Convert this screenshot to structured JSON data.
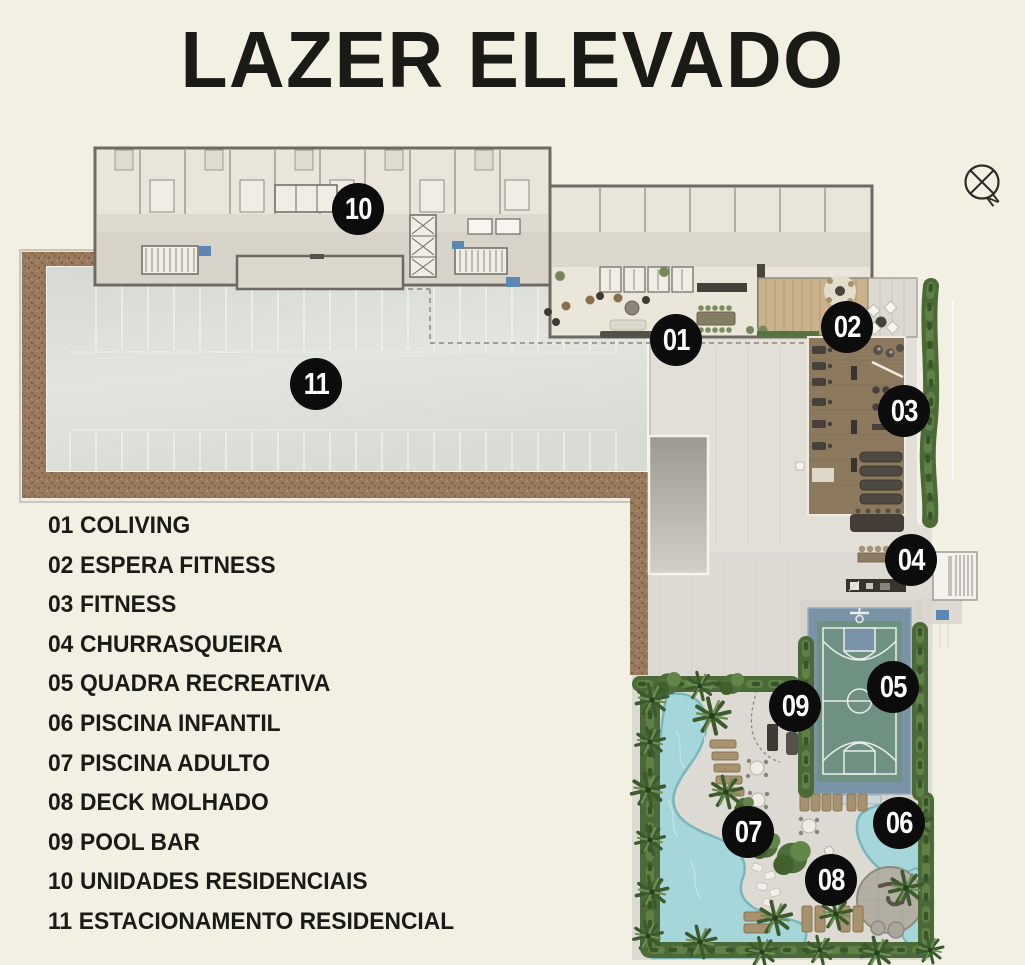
{
  "header": {
    "title": "LAZER ELEVADO"
  },
  "compass": {
    "north_label": "N"
  },
  "legend": {
    "items": [
      {
        "num": "01",
        "label": "COLIVING"
      },
      {
        "num": "02",
        "label": "ESPERA FITNESS"
      },
      {
        "num": "03",
        "label": "FITNESS"
      },
      {
        "num": "04",
        "label": "CHURRASQUEIRA"
      },
      {
        "num": "05",
        "label": "QUADRA RECREATIVA"
      },
      {
        "num": "06",
        "label": "PISCINA INFANTIL"
      },
      {
        "num": "07",
        "label": "PISCINA ADULTO"
      },
      {
        "num": "08",
        "label": "DECK MOLHADO"
      },
      {
        "num": "09",
        "label": "POOL BAR"
      },
      {
        "num": "10",
        "label": "UNIDADES RESIDENCIAIS"
      },
      {
        "num": "11",
        "label": "ESTACIONAMENTO RESIDENCIAL"
      }
    ]
  },
  "markers": [
    {
      "number": "01",
      "area": "COLIVING"
    },
    {
      "number": "02",
      "area": "ESPERA FITNESS"
    },
    {
      "number": "03",
      "area": "FITNESS"
    },
    {
      "number": "04",
      "area": "CHURRASQUEIRA"
    },
    {
      "number": "05",
      "area": "QUADRA RECREATIVA"
    },
    {
      "number": "06",
      "area": "PISCINA INFANTIL"
    },
    {
      "number": "07",
      "area": "PISCINA ADULTO"
    },
    {
      "number": "08",
      "area": "DECK MOLHADO"
    },
    {
      "number": "09",
      "area": "POOL BAR"
    },
    {
      "number": "10",
      "area": "UNIDADES RESIDENCIAIS"
    },
    {
      "number": "11",
      "area": "ESTACIONAMENTO RESIDENCIAL"
    }
  ],
  "colors": {
    "background": "#f2efe3",
    "ink": "#1a1a16",
    "marker_bg": "#0c0c0c",
    "marker_text": "#ffffff",
    "pool_water": "#a5d6da",
    "court_green": "#6f9181",
    "court_blue": "#7b93a6",
    "hedge_green": "#4c6a38",
    "earth_brown": "#9a7a5c",
    "wood_floor": "#c9b28c",
    "fitness_floor": "#8c795e"
  }
}
